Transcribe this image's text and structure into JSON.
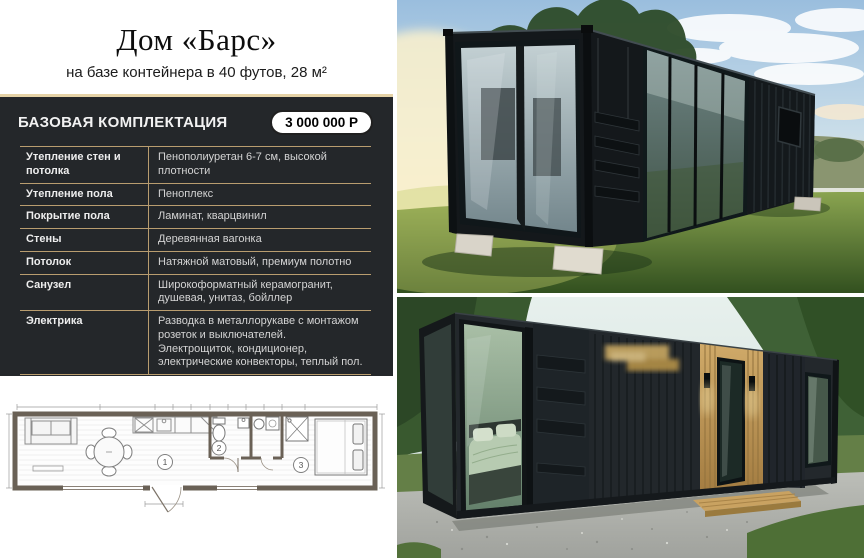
{
  "title": "Дом «Барс»",
  "subtitle": "на базе  контейнера в 40 футов, 28 м²",
  "spec_panel": {
    "header": "БАЗОВАЯ КОМПЛЕКТАЦИЯ",
    "price": "3 000 000 Р",
    "rows": [
      {
        "label": "Утепление стен и потолка",
        "value": "Пенополиуретан 6-7 см, высокой плотности"
      },
      {
        "label": "Утепление пола",
        "value": "Пеноплекс"
      },
      {
        "label": "Покрытие пола",
        "value": "Ламинат, кварцвинил"
      },
      {
        "label": "Стены",
        "value": "Деревянная вагонка"
      },
      {
        "label": "Потолок",
        "value": "Натяжной матовый, премиум полотно"
      },
      {
        "label": "Санузел",
        "value": "Широкоформатный керамогранит, душевая, унитаз, бойллер"
      },
      {
        "label": "Электрика",
        "value": "Разводка в металлорукаве с монтажом розеток и выключателей.\nЭлектрощиток, кондиционер, электрические конвекторы, теплый пол."
      }
    ]
  },
  "floor_plan": {
    "room_labels": [
      "1",
      "2",
      "3"
    ]
  },
  "colors": {
    "accent_gold": "#b99d6f",
    "header_top_border": "#e5d2a6",
    "panel_background": "#24272a",
    "price_pill_background": "#ffffff"
  }
}
